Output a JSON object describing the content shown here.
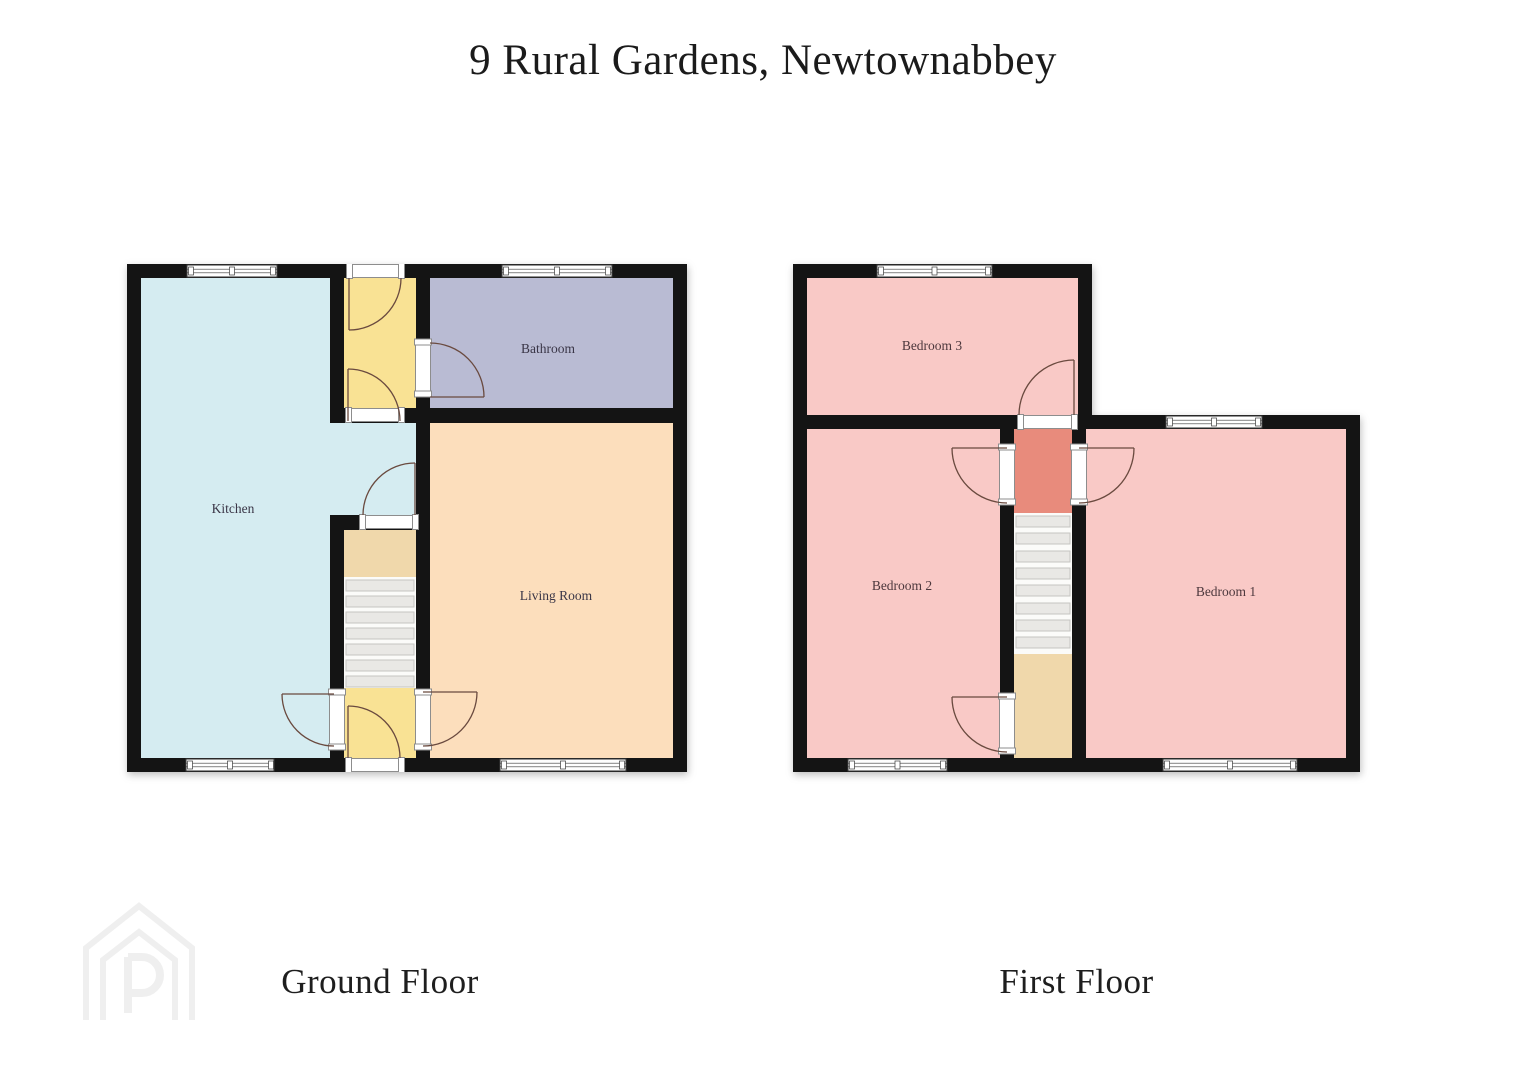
{
  "title": "9 Rural Gardens, Newtownabbey",
  "floors": [
    {
      "name": "Ground Floor",
      "rooms": [
        {
          "label": "Kitchen"
        },
        {
          "label": "Bathroom"
        },
        {
          "label": "Living Room"
        }
      ]
    },
    {
      "name": "First Floor",
      "rooms": [
        {
          "label": "Bedroom 3"
        },
        {
          "label": "Bedroom 2"
        },
        {
          "label": "Bedroom 1"
        }
      ]
    }
  ],
  "colors": {
    "wall": "#141414",
    "kitchen": "#d5ecf1",
    "bathroom": "#b9bbd3",
    "living_room": "#fcdebc",
    "hallway_yellow": "#f9e294",
    "bedroom_pink": "#f9c9c6",
    "landing_red": "#e88b7c",
    "landing_tan": "#f0d8ab"
  },
  "watermark_letter": "P"
}
